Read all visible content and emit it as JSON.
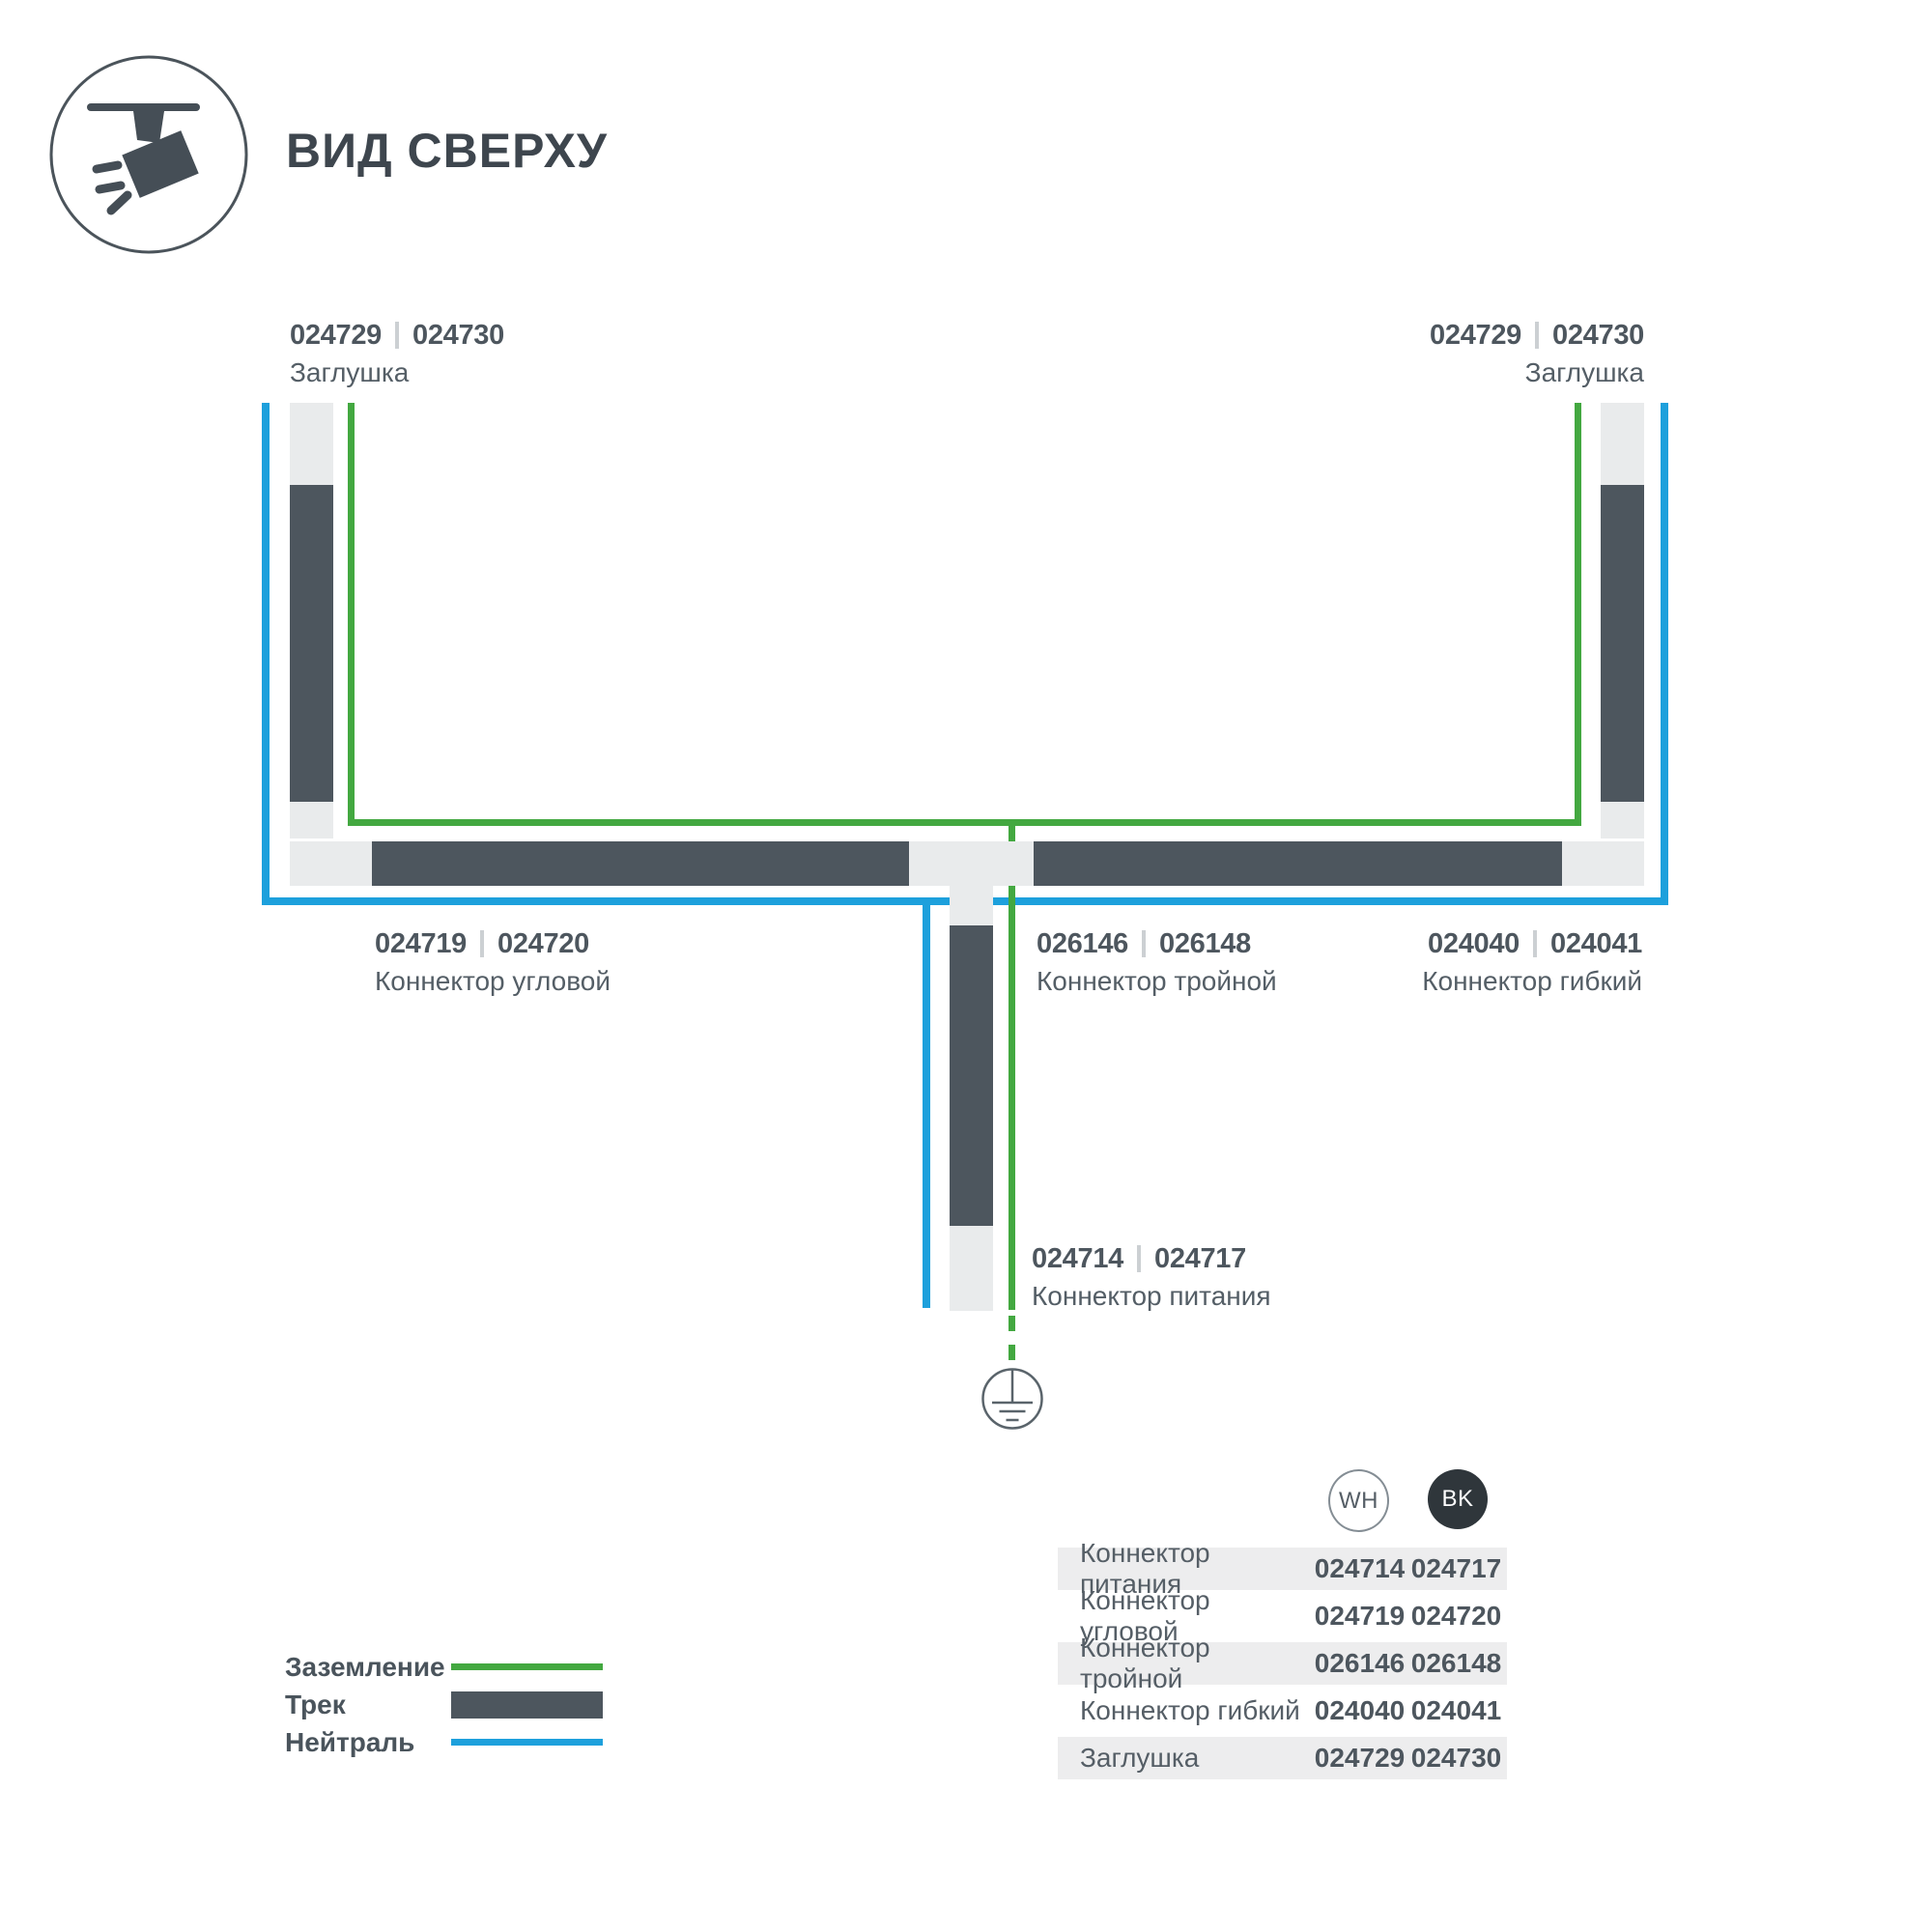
{
  "header": {
    "title": "ВИД СВЕРХУ",
    "icon": "track-spotlight-icon"
  },
  "colors": {
    "ground_green": "#43a840",
    "neutral_blue": "#1da0dc",
    "track_dark": "#4d565e",
    "connector_light": "#e9ebec",
    "table_stripe": "#ededee",
    "bk_badge": "#2f363b"
  },
  "diagram": {
    "labels": {
      "cap_top_left": {
        "code_wh": "024729",
        "code_bk": "024730",
        "name": "Заглушка"
      },
      "cap_top_right": {
        "code_wh": "024729",
        "code_bk": "024730",
        "name": "Заглушка"
      },
      "corner_connector": {
        "code_wh": "024719",
        "code_bk": "024720",
        "name": "Коннектор угловой"
      },
      "triple_connector": {
        "code_wh": "026146",
        "code_bk": "026148",
        "name": "Коннектор тройной"
      },
      "flexible_connector": {
        "code_wh": "024040",
        "code_bk": "024041",
        "name": "Коннектор гибкий"
      },
      "power_connector": {
        "code_wh": "024714",
        "code_bk": "024717",
        "name": "Коннектор питания"
      }
    }
  },
  "legend": {
    "items": [
      {
        "label": "Заземление",
        "type": "ground"
      },
      {
        "label": "Трек",
        "type": "track"
      },
      {
        "label": "Нейтраль",
        "type": "neutral"
      }
    ]
  },
  "table": {
    "col_wh": "WH",
    "col_bk": "BK",
    "rows": [
      {
        "label": "Коннектор питания",
        "wh": "024714",
        "bk": "024717"
      },
      {
        "label": "Коннектор угловой",
        "wh": "024719",
        "bk": "024720"
      },
      {
        "label": "Коннектор тройной",
        "wh": "026146",
        "bk": "026148"
      },
      {
        "label": "Коннектор гибкий",
        "wh": "024040",
        "bk": "024041"
      },
      {
        "label": "Заглушка",
        "wh": "024729",
        "bk": "024730"
      }
    ]
  }
}
